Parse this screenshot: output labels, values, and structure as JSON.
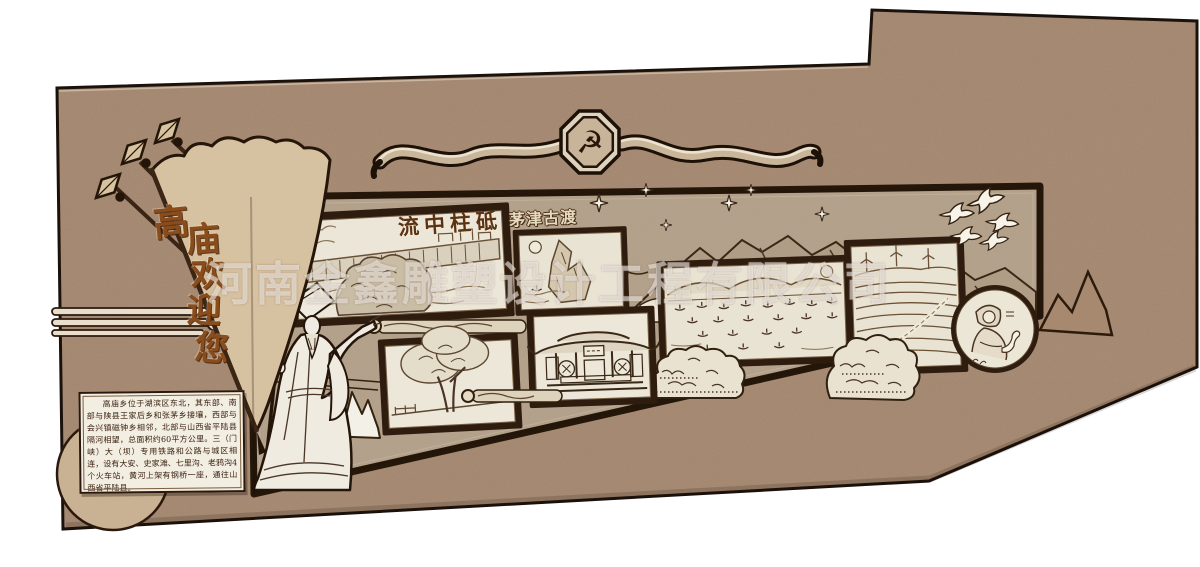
{
  "watermark": {
    "text": "河南金鑫雕塑设计工程有限公司",
    "color": "rgba(255,255,255,0.52)"
  },
  "emblem": {
    "name": "party-emblem",
    "symbol": "☭"
  },
  "flag": {
    "text": "高庙欢迎您",
    "chars": [
      "高",
      "庙",
      "欢",
      "迎",
      "您"
    ]
  },
  "labels": {
    "dam": "流中柱砥",
    "ferry": "茅津古渡"
  },
  "info_panel": {
    "text": "高庙乡位于湖滨区东北，其东部、南部与陕县王家后乡和张茅乡接壤，西部与会兴镇磁钟乡相邻，北部与山西省平陆县隔河相望，总面积约60平方公里。三（门峡）大（坝）专用铁路和公路与城区相连，设有大安、史家滩、七里沟、老鸦沟4个火车站，黄河上架有钢桥一座，通往山西省平陆县。"
  },
  "icons": {
    "emblem": "hammer-and-sickle",
    "birds": "dove-icons",
    "sparkles": "four-point-star-icons",
    "spears": "spearhead-flagpole-icons"
  },
  "colors": {
    "wall": "#a98c74",
    "panel": "#b6a48e",
    "frame": "#2e1c0e",
    "paper": "#ebe5d6",
    "flag_fill": "#d6c1a1",
    "sketch_ink": "#6b5136",
    "outline": "#241509",
    "cream": "#ece5d4"
  }
}
